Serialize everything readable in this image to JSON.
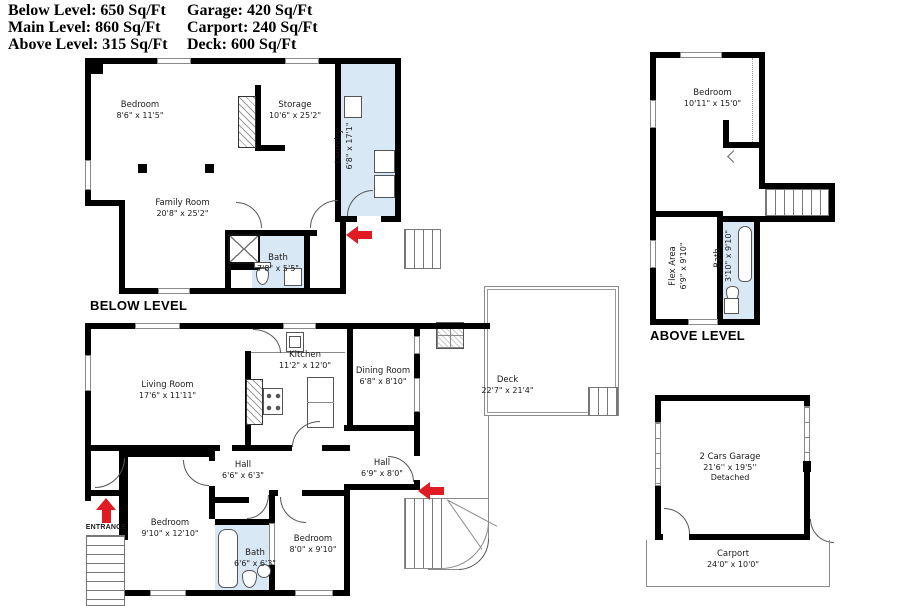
{
  "summary": {
    "col1": [
      "Below Level: 650 Sq/Ft",
      "Main Level: 860 Sq/Ft",
      "Above Level: 315 Sq/Ft"
    ],
    "col2": [
      "Garage: 420 Sq/Ft",
      "Carport: 240 Sq/Ft",
      "Deck: 600 Sq/Ft"
    ]
  },
  "below": {
    "title": "BELOW LEVEL",
    "rooms": {
      "bedroom": {
        "name": "Bedroom",
        "dims": "8'6\" x 11'5\""
      },
      "storage": {
        "name": "Storage",
        "dims": "10'6\" x 25'2\""
      },
      "laundry": {
        "name": "Laundry",
        "dims": "6'8\" x 17'1\""
      },
      "family": {
        "name": "Family Room",
        "dims": "20'8\" x 25'2\""
      },
      "bath": {
        "name": "Bath",
        "dims": "7'8\" x 5'5\""
      }
    }
  },
  "above": {
    "title": "ABOVE LEVEL",
    "rooms": {
      "bedroom": {
        "name": "Bedroom",
        "dims": "10'11\" x 15'0\""
      },
      "flex": {
        "name": "Flex Area",
        "dims": "6'9\" x 9'10\""
      },
      "bath": {
        "name": "Bath",
        "dims": "3'10\" x 9'10\""
      }
    }
  },
  "main": {
    "entrance_label": "ENTRANCE",
    "rooms": {
      "living": {
        "name": "Living Room",
        "dims": "17'6\" x 11'11\""
      },
      "kitchen": {
        "name": "Kitchen",
        "dims": "11'2\" x 12'0\""
      },
      "dining": {
        "name": "Dining Room",
        "dims": "6'8\" x 8'10\""
      },
      "hall_right": {
        "name": "Hall",
        "dims": "6'9\" x 8'0\""
      },
      "hall_left": {
        "name": "Hall",
        "dims": "6'6\" x 6'3\""
      },
      "bedroom_left": {
        "name": "Bedroom",
        "dims": "9'10\" x 12'10\""
      },
      "bedroom_mid": {
        "name": "Bedroom",
        "dims": "8'0\" x 9'10\""
      },
      "bath": {
        "name": "Bath",
        "dims": "6'6\" x 6'3\""
      },
      "deck": {
        "name": "Deck",
        "dims": "22'7\" x 21'4\""
      }
    }
  },
  "outbuildings": {
    "garage": {
      "line1": "2 Cars Garage",
      "line2": "21'6'' x 19'5''",
      "line3": "Detached"
    },
    "carport": {
      "name": "Carport",
      "dims": "24'0\" x 10'0\""
    }
  },
  "icons": {
    "entrance_arrow": "arrow-up",
    "door_arrows": "arrow-left"
  },
  "colors": {
    "wall": "#000000",
    "wet_room_fill": "#d9e8f5",
    "arrow_red": "#e01b24"
  }
}
